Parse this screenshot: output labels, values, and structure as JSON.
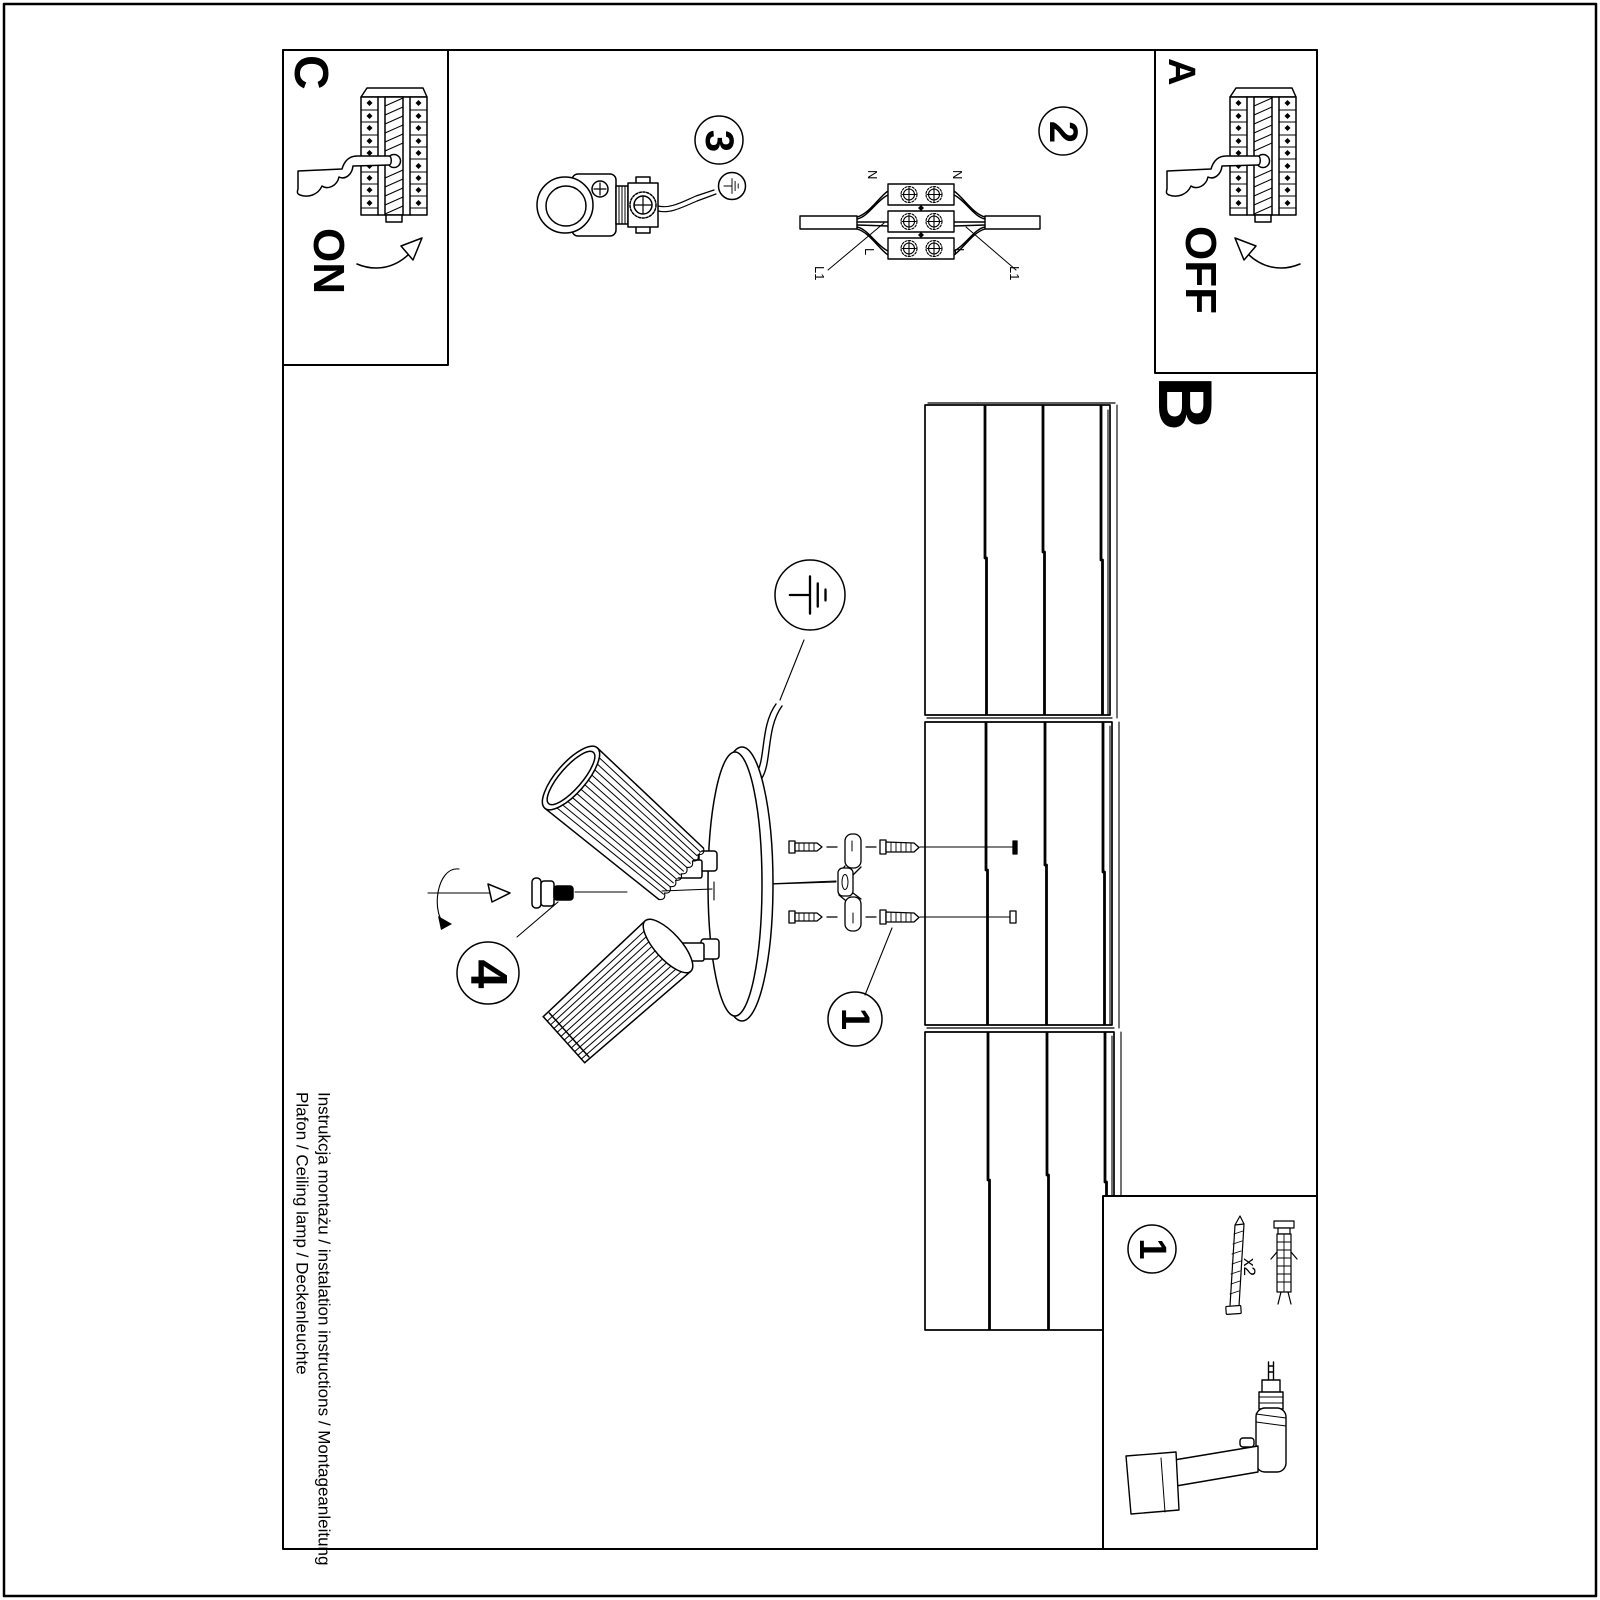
{
  "document": {
    "footer_line1": "Instrukcja montażu / instalation instructions / Montageanleitung",
    "footer_line2": "Plafon / Ceiling lamp / Deckenleuchte"
  },
  "sections": {
    "a": {
      "label": "A",
      "switch_state": "OFF"
    },
    "b": {
      "label": "B"
    },
    "c": {
      "label": "C",
      "switch_state": "ON"
    }
  },
  "steps": {
    "mounting": "1",
    "wiring": "2",
    "holder": "3",
    "adjustment": "4",
    "parts_kit": "1"
  },
  "terminal": {
    "n_left": "N",
    "n_right": "N",
    "l_left": "L",
    "l_right": "L",
    "l1_left": "L1",
    "l1_right": "L1"
  },
  "parts": {
    "screw_plug_qty": "x2"
  },
  "colors": {
    "ink": "#000000",
    "paper": "#ffffff"
  }
}
